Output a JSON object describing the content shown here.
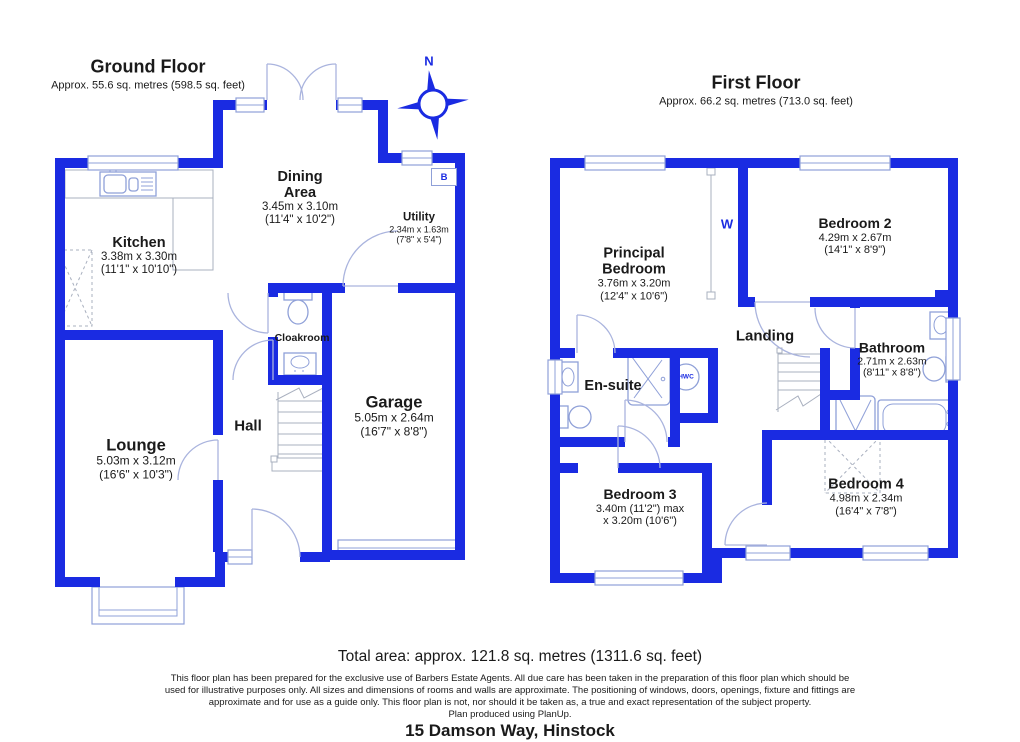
{
  "ground_floor": {
    "title": "Ground Floor",
    "area": "Approx. 55.6 sq. metres (598.5 sq. feet)",
    "rooms": {
      "kitchen": {
        "name": "Kitchen",
        "metric": "3.38m x 3.30m",
        "imperial": "(11'1\" x 10'10\")"
      },
      "dining": {
        "name_line1": "Dining",
        "name_line2": "Area",
        "metric": "3.45m x 3.10m",
        "imperial": "(11'4\" x 10'2\")"
      },
      "utility": {
        "name": "Utility",
        "metric": "2.34m x 1.63m",
        "imperial": "(7'8\" x 5'4\")"
      },
      "cloakroom": {
        "name": "Cloakroom"
      },
      "lounge": {
        "name": "Lounge",
        "metric": "5.03m x 3.12m",
        "imperial": "(16'6\" x 10'3\")"
      },
      "hall": {
        "name": "Hall"
      },
      "garage": {
        "name": "Garage",
        "metric": "5.05m x 2.64m",
        "imperial": "(16'7\" x 8'8\")"
      }
    },
    "markers": {
      "boiler": "B"
    }
  },
  "first_floor": {
    "title": "First Floor",
    "area": "Approx. 66.2 sq. metres (713.0 sq. feet)",
    "rooms": {
      "principal_bedroom": {
        "name_line1": "Principal",
        "name_line2": "Bedroom",
        "metric": "3.76m x 3.20m",
        "imperial": "(12'4\" x 10'6\")"
      },
      "bedroom2": {
        "name": "Bedroom 2",
        "metric": "4.29m x 2.67m",
        "imperial": "(14'1\" x 8'9\")"
      },
      "landing": {
        "name": "Landing"
      },
      "bathroom": {
        "name": "Bathroom",
        "metric": "2.71m x 2.63m",
        "imperial": "(8'11\" x 8'8\")"
      },
      "ensuite": {
        "name": "En-suite"
      },
      "bedroom3": {
        "name": "Bedroom 3",
        "metric_line1": "3.40m (11'2\") max",
        "metric_line2": "x 3.20m (10'6\")"
      },
      "bedroom4": {
        "name": "Bedroom 4",
        "metric": "4.98m x 2.34m",
        "imperial": "(16'4\" x 7'8\")"
      }
    },
    "markers": {
      "wardrobe": "W",
      "hwc": "HWC"
    }
  },
  "compass": {
    "north_label": "N"
  },
  "footer": {
    "total_area": "Total area: approx. 121.8 sq. metres (1311.6 sq. feet)",
    "disclaimer": "This floor plan has been prepared for the exclusive use of Barbers Estate Agents. All due care has been taken in the preparation of this floor plan which should be used for illustrative purposes only. All sizes and dimensions of rooms and walls are approximate. The positioning of windows, doors, openings, fixture and fittings are approximate and for use as a guide only. This floor plan is not, nor should it be taken as, a true and exact representation of the subject property.",
    "produced": "Plan produced using PlanUp.",
    "address": "15 Damson Way, Hinstock"
  },
  "colors": {
    "wall_blue": "#1a2be2",
    "fixture_blue": "#8fa0d8"
  }
}
